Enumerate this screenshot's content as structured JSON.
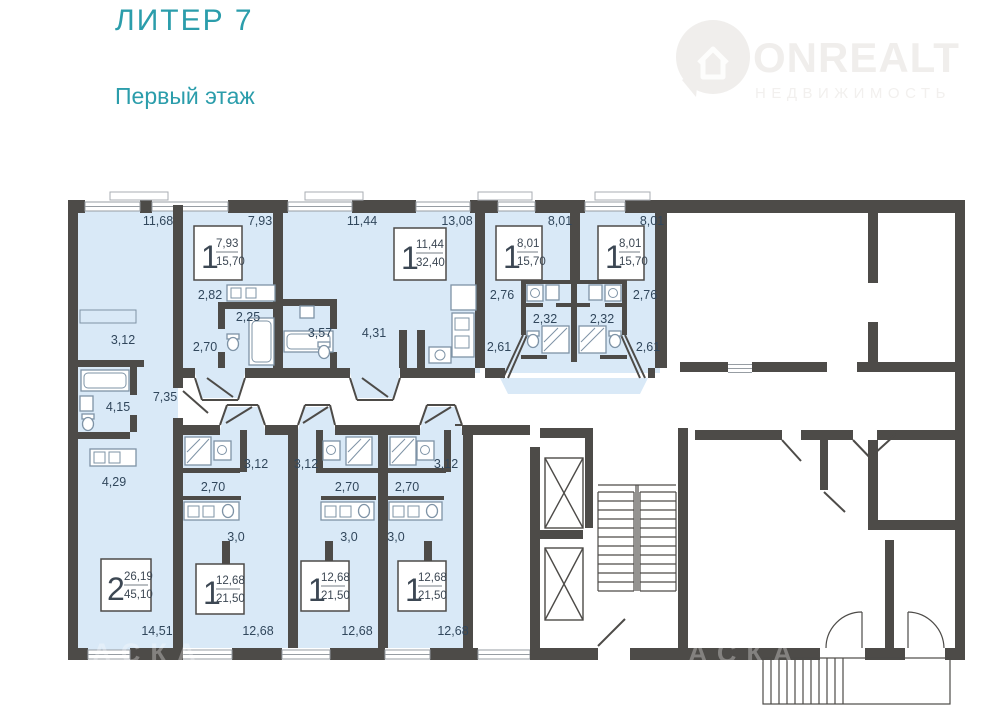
{
  "header": {
    "title": "ЛИТЕР 7",
    "subtitle": "Первый этаж"
  },
  "brand": {
    "name": "ONREALT",
    "tagline": "НЕДВИЖИМОСТЬ"
  },
  "watermark": "АСКА",
  "colors": {
    "accent": "#2b9dab",
    "wall": "#4d4b48",
    "apartment_fill": "#d9e9f7",
    "dimension_text": "#31475c"
  },
  "apartments": [
    {
      "rooms": "1",
      "living_area": "7,93",
      "total_area": "15,70"
    },
    {
      "rooms": "1",
      "living_area": "11,44",
      "total_area": "32,40"
    },
    {
      "rooms": "1",
      "living_area": "8,01",
      "total_area": "15,70"
    },
    {
      "rooms": "1",
      "living_area": "8,01",
      "total_area": "15,70"
    },
    {
      "rooms": "2",
      "living_area": "26,19",
      "total_area": "45,10"
    },
    {
      "rooms": "1",
      "living_area": "12,68",
      "total_area": "21,50"
    },
    {
      "rooms": "1",
      "living_area": "12,68",
      "total_area": "21,50"
    },
    {
      "rooms": "1",
      "living_area": "12,68",
      "total_area": "21,50"
    }
  ],
  "dims": [
    "11,68",
    "7,93",
    "11,44",
    "13,08",
    "8,01",
    "8,01",
    "2,82",
    "2,25",
    "2,70",
    "3,57",
    "4,31",
    "2,76",
    "2,32",
    "2,61",
    "2,76",
    "2,32",
    "2,61",
    "3,12",
    "4,15",
    "7,35",
    "4,29",
    "14,51",
    "3,12",
    "2,70",
    "3,0",
    "3,12",
    "2,70",
    "3,0",
    "3,12",
    "2,70",
    "3,0",
    "12,68",
    "12,68",
    "12,68"
  ]
}
